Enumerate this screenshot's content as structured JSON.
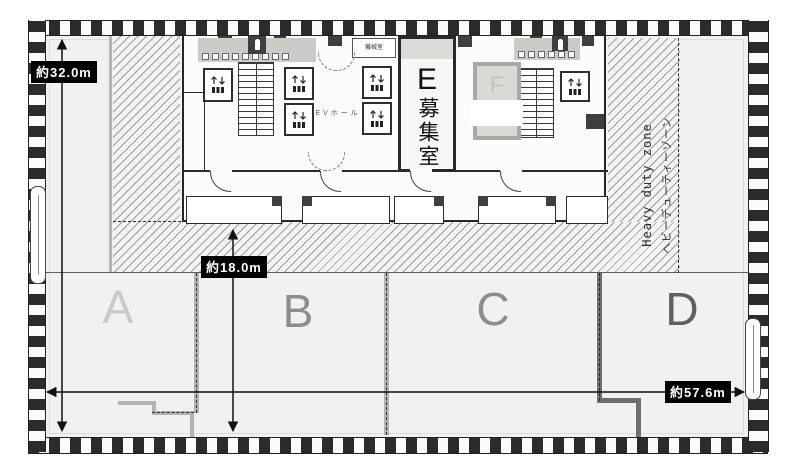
{
  "dimensions": {
    "height_left": "約32.0m",
    "depth_center": "約18.0m",
    "width_bottom": "約57.6m"
  },
  "heavy_duty_zone": {
    "label_en": "Heavy duty zone",
    "label_ja": "ヘビーデューティーゾーン"
  },
  "core": {
    "ev_hall_label": "EVホール",
    "machine_room_label": "機械室"
  },
  "units": {
    "e_label": "E",
    "e_status": "募集室",
    "f_label": "F"
  },
  "sections": [
    {
      "label": "A"
    },
    {
      "label": "B"
    },
    {
      "label": "C"
    },
    {
      "label": "D"
    }
  ],
  "colors": {
    "floor": "#f1f1ef",
    "wall": "#262626",
    "hatch_line": "#9b9b98",
    "lease_line": "#b3b3b0",
    "dimension_label_bg": "#000000",
    "dimension_label_text": "#ffffff",
    "section_letter": "#8d8d8a"
  }
}
